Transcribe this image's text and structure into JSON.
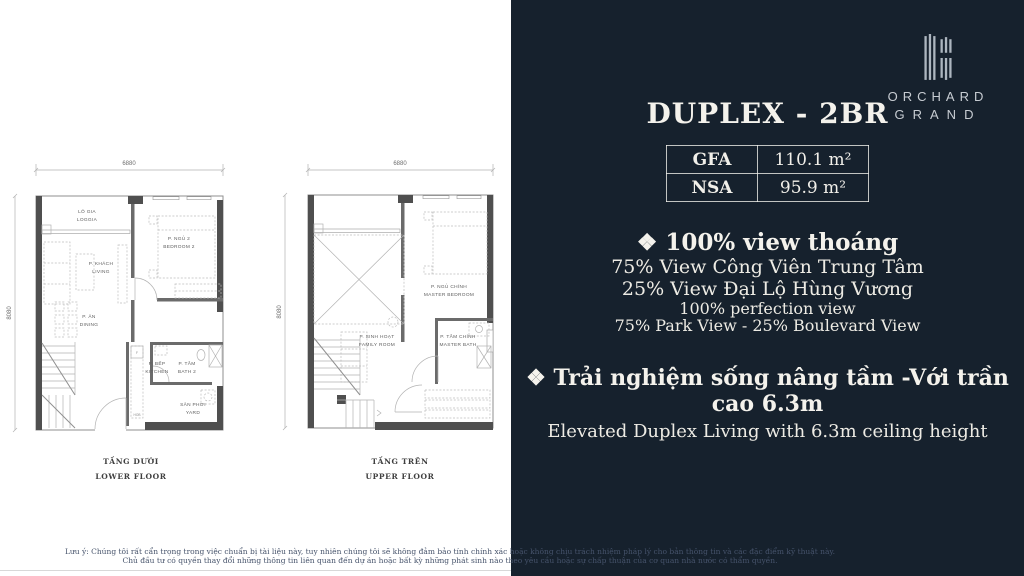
{
  "colors": {
    "panel_bg": "#16212D",
    "panel_text": "#F1EFE9",
    "wall": "#4F4F4F",
    "logo_gray": "#ADB6BF"
  },
  "brand": {
    "line1": "ORCHARD",
    "line2": "GRAND"
  },
  "panel": {
    "title": "DUPLEX - 2BR",
    "spec_table": {
      "rows": [
        {
          "label": "GFA",
          "value": "110.1 m²"
        },
        {
          "label": "NSA",
          "value": "95.9 m²"
        }
      ]
    },
    "highlight1": {
      "marker": "❖",
      "heading": "❖ 100% view thoáng",
      "line1": "75% View Công Viên Trung Tâm",
      "line2": "25% View Đại Lộ Hùng Vương",
      "line3": "100% perfection view",
      "line4": "75% Park View - 25%  Boulevard View"
    },
    "highlight2": {
      "marker": "❖",
      "heading": "❖ Trải nghiệm sống nâng tầm  -Với trần cao 6.3m",
      "subheading": "Elevated Duplex Living with 6.3m ceiling height"
    }
  },
  "floorplans": {
    "lower": {
      "dim_width": "6880",
      "dim_height": "8080",
      "caption_vi": "TẦNG DƯỚI",
      "caption_en": "LOWER FLOOR",
      "rooms": {
        "loggia": {
          "vi": "LÔ GIA",
          "en": "LOGGIA"
        },
        "living": {
          "vi": "P. KHÁCH",
          "en": "LIVING"
        },
        "bedroom2": {
          "vi": "P. NGỦ 2",
          "en": "BEDROOM 2"
        },
        "dining": {
          "vi": "P. ĂN",
          "en": "DINING"
        },
        "kitchen": {
          "vi": "P. BẾP",
          "en": "KITCHEN",
          "fridge": "F",
          "hob": "HOB"
        },
        "bath2": {
          "vi": "P. TẮM",
          "en": "BATH 2"
        },
        "yard": {
          "vi": "SÂN PHƠI",
          "en": "YARD"
        }
      }
    },
    "upper": {
      "dim_width": "6880",
      "dim_height": "8080",
      "caption_vi": "TẦNG TRÊN",
      "caption_en": "UPPER FLOOR",
      "rooms": {
        "master_bedroom": {
          "vi": "P. NGỦ CHÍNH",
          "en": "MASTER BEDROOM"
        },
        "family": {
          "vi": "P. SINH HOẠT",
          "en": "FAMILY ROOM"
        },
        "master_bath": {
          "vi": "P. TẮM CHÍNH",
          "en": "MASTER BATH"
        }
      }
    }
  },
  "disclaimer": {
    "line1": "Lưu ý: Chúng tôi rất cẩn trọng trong việc chuẩn bị tài liệu này, tuy nhiên chúng tôi sẽ không đảm bảo tính chính xác hoặc không chịu trách nhiệm pháp lý cho bản thông tin và các đặc điểm kỹ thuật này.",
    "line2": "Chủ đầu tư có quyền thay đổi những thông tin liên quan đến dự án hoặc bất kỳ những phát sinh nào theo yêu cầu hoặc sự chấp thuận của cơ quan nhà nước có thẩm quyền."
  }
}
